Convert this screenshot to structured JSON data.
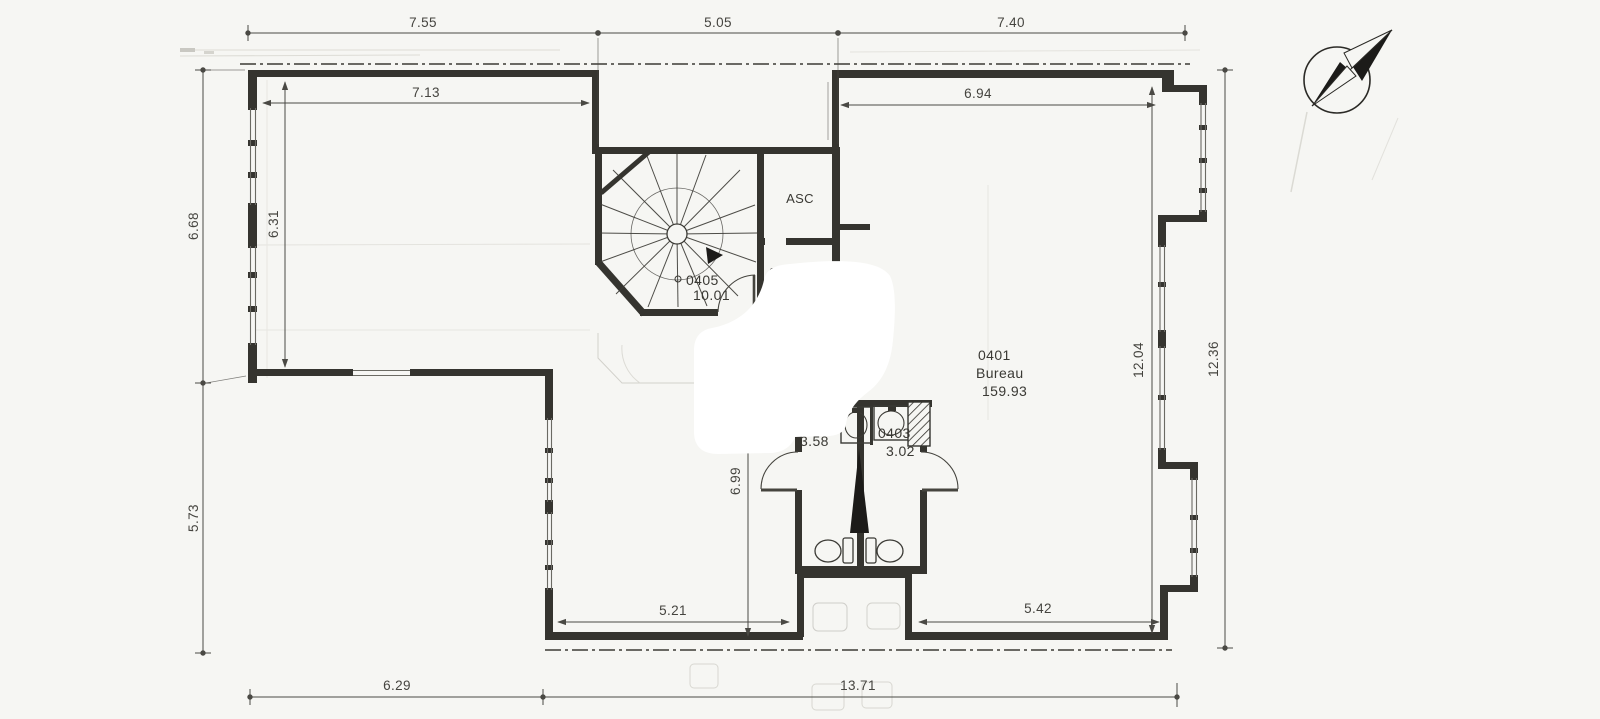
{
  "drawing": {
    "type": "architectural-floor-plan",
    "icons": {
      "compass": "compass-north-icon"
    },
    "colors": {
      "paper": "#f6f6f3",
      "ink": "#35342f",
      "dim_line": "#4a4944",
      "ghost": "#d9d8d2",
      "whiteout": "#ffffff",
      "shaft_fill": "#1c1b19"
    }
  },
  "dims": {
    "top_left": "7.55",
    "top_mid": "5.05",
    "top_right": "7.40",
    "inner_top_left": "7.13",
    "inner_top_right": "6.94",
    "left_upper": "6.68",
    "left_inner": "6.31",
    "left_lower": "5.73",
    "right_inner": "12.04",
    "right_outer": "12.36",
    "center_vert": "6.99",
    "bottom_inner_left": "5.21",
    "bottom_inner_right": "5.42",
    "bottom_left": "6.29",
    "bottom_right": "13.71"
  },
  "rooms": {
    "stair_number": "0405",
    "stair_area": "10.01",
    "elevator_label": "ASC",
    "bureau_number": "0401",
    "bureau_name": "Bureau",
    "bureau_area": "159.93",
    "wc_left_area": "3.58",
    "wc_right_number": "0403",
    "wc_right_area": "3.02",
    "fragment_number": "040",
    "fragment_letter": "b"
  }
}
